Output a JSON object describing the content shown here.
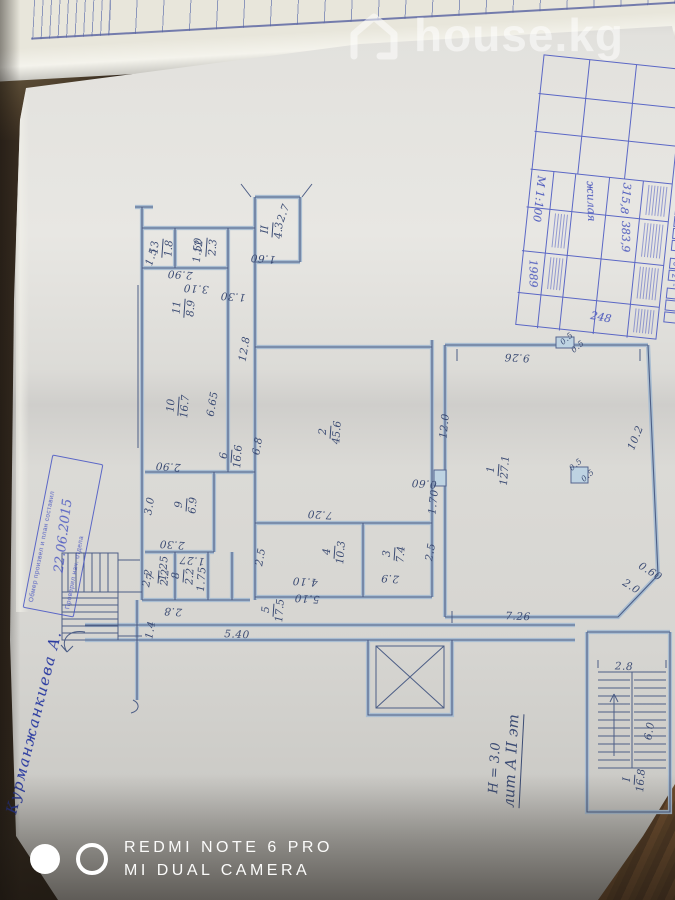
{
  "watermarks": {
    "site": {
      "name": "house.kg",
      "icon": "house-outline-icon"
    },
    "camera": {
      "line1": "REDMI NOTE 6 PRO",
      "line2": "MI DUAL CAMERA"
    }
  },
  "notebook": {
    "digits": [
      "1",
      "5",
      "1",
      "8",
      "6",
      "2",
      "6"
    ]
  },
  "plan": {
    "rooms": [
      {
        "n": "II",
        "a": "4.3"
      },
      {
        "n": "12",
        "a": "2.3"
      },
      {
        "n": "13",
        "a": "1.8"
      },
      {
        "n": "11",
        "a": "8.9"
      },
      {
        "n": "10",
        "a": "16.7"
      },
      {
        "n": "6",
        "a": "16.6"
      },
      {
        "n": "2",
        "a": "45.6"
      },
      {
        "n": "9",
        "a": "6.9"
      },
      {
        "n": "7",
        "a": "2.2"
      },
      {
        "n": "8",
        "a": "2.2"
      },
      {
        "n": "5",
        "a": "17.5"
      },
      {
        "n": "4",
        "a": "10.3"
      },
      {
        "n": "3",
        "a": "7.4"
      },
      {
        "n": "1",
        "a": "127.1"
      },
      {
        "n": "I",
        "a": "16.8"
      }
    ],
    "dims": [
      "2.7",
      "1.60",
      "1.30",
      "12.8",
      "2.90",
      "3.10",
      "1.50",
      "1.5",
      "6.65",
      "2.90",
      "6.8",
      "12.0",
      "0.60",
      "1.70",
      "7.20",
      "4.10",
      "2.5",
      "2.9",
      "2.5",
      "5.10",
      "5.40",
      "1.4",
      "2.30",
      "3.0",
      "1.27",
      "1.75",
      "2.8",
      "9.26",
      "10.2",
      "7.26",
      "0.60",
      "2.0",
      "2.8",
      "6.0",
      "0.5",
      "0.5",
      "0.5",
      "0.5",
      "2.2",
      "1.25"
    ],
    "notes": [
      "лит А II эт",
      "Н = 3.0"
    ]
  },
  "stamp": {
    "line1": "Обмер произвел и план составил",
    "date": "22.06.2015",
    "line2": "Проверил нач. отдела"
  },
  "titleblock": {
    "code": "2-66-23-0023-0572-02-***",
    "scale": "М 1:100",
    "year": "1989",
    "total_area": "383,9",
    "living_area": "315,8",
    "purpose": "жилая",
    "number": "248"
  },
  "signature": "Курманжанкиева А."
}
